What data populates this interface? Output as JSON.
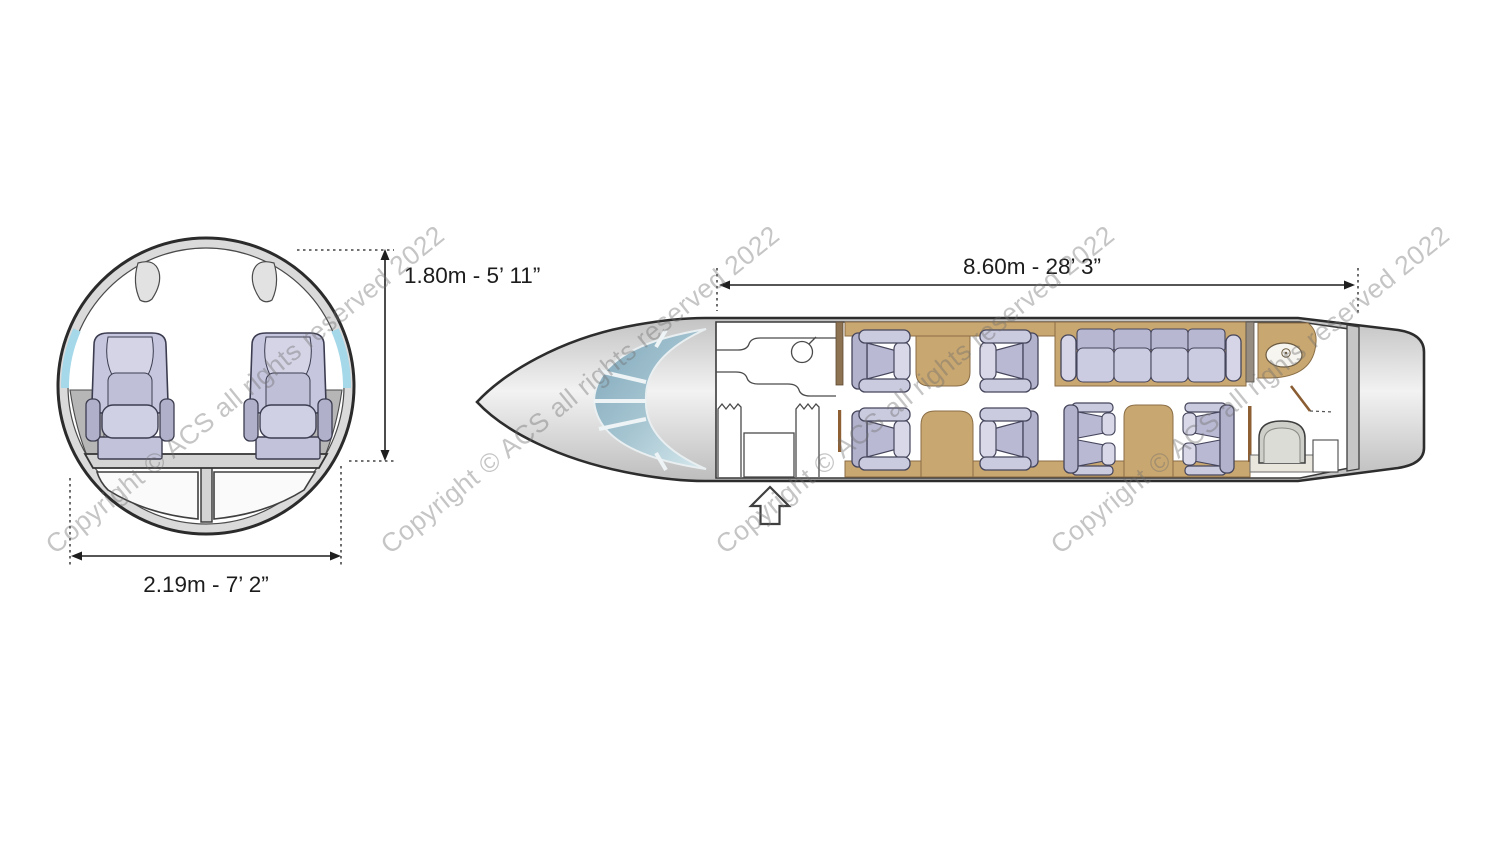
{
  "diagram": {
    "type": "aircraft-cabin-layout",
    "watermark": {
      "text": "Copyright © ACS all rights reserved 2022",
      "color": "#6f6f6f",
      "opacity": 0.4,
      "angle_deg": -39,
      "instances": 4
    },
    "cross_section": {
      "height_label": "1.80m - 5’ 11”",
      "width_label": "2.19m - 7’ 2”",
      "seats_abreast": 2,
      "features": [
        "fuselage-ring",
        "cabin-windows",
        "overhead-panels",
        "sidewall-ledges",
        "cabin-floor",
        "underfloor-cargo-bays",
        "two-passenger-seats"
      ]
    },
    "floor_plan": {
      "cabin_length_label": "8.60m - 28’ 3”",
      "single_seats": 4,
      "divan_seats": 4,
      "bench_seats": 4,
      "features": [
        "cockpit-windshield",
        "galley-with-sink",
        "entry-door-with-arrow",
        "club-seating-with-side-tables",
        "four-place-divan",
        "side-cabinet",
        "lavatory-with-sink-and-toilet",
        "aft-bulkhead",
        "tailcone"
      ]
    },
    "colors": {
      "fuselage_fill": "#d9d9d9",
      "fuselage_outline": "#2d2d2d",
      "seat_upholstery": "#c6c6de",
      "tan_trim": "#c9a770",
      "window_tint": "#a5d8e8",
      "windshield_tint": "#8fb3c5",
      "dimension_text": "#1c1c1c"
    }
  }
}
